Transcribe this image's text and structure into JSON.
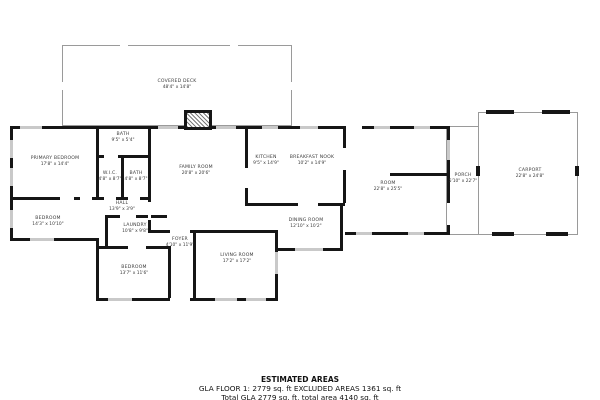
{
  "plan": {
    "rooms": [
      {
        "name": "COVERED DECK",
        "dims": "48'4\" x 14'8\""
      },
      {
        "name": "PRIMARY BEDROOM",
        "dims": "17'8\" x 14'4\""
      },
      {
        "name": "BATH",
        "dims": "9'5\" x 5'4\""
      },
      {
        "name": "W.I.C.",
        "dims": "4'8\" x 8'7\""
      },
      {
        "name": "BATH",
        "dims": "4'8\" x 8'7\""
      },
      {
        "name": "FAMILY ROOM",
        "dims": "20'8\" x 20'6\""
      },
      {
        "name": "KITCHEN",
        "dims": "9'5\" x 14'9\""
      },
      {
        "name": "BREAKFAST NOOK",
        "dims": "10'2\" x 14'9\""
      },
      {
        "name": "HALL",
        "dims": "13'9\" x 3'9\""
      },
      {
        "name": "BEDROOM",
        "dims": "14'3\" x 10'10\""
      },
      {
        "name": "LAUNDRY",
        "dims": "10'8\" x 9'8\""
      },
      {
        "name": "DINING ROOM",
        "dims": "12'10\" x 10'2\""
      },
      {
        "name": "FOYER",
        "dims": "4'10\" x 11'9\""
      },
      {
        "name": "BEDROOM",
        "dims": "13'7\" x 11'6\""
      },
      {
        "name": "LIVING ROOM",
        "dims": "17'2\" x 17'2\""
      },
      {
        "name": "ROOM",
        "dims": "22'8\" x 25'5\""
      },
      {
        "name": "PORCH",
        "dims": "5'10\" x 22'7\""
      },
      {
        "name": "CARPORT",
        "dims": "22'8\" x 24'8\""
      }
    ]
  },
  "footer": {
    "title": "ESTIMATED AREAS",
    "line1": "GLA FLOOR 1: 2779 sq. ft EXCLUDED AREAS 1361 sq. ft",
    "line2": "Total GLA 2779 sq. ft, total area 4140 sq. ft"
  }
}
